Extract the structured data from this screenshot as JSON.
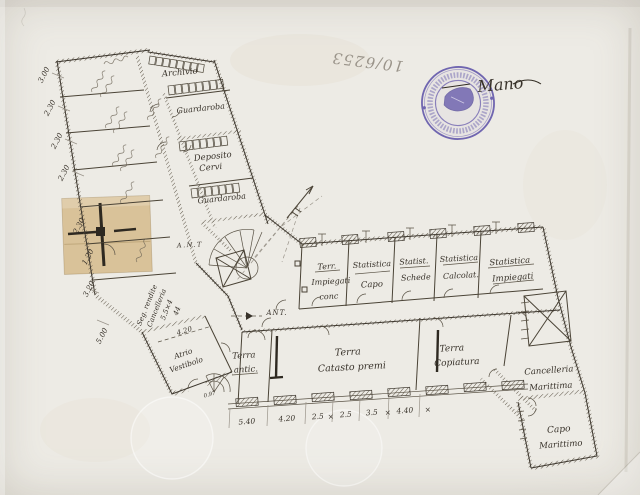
{
  "meta": {
    "inventory_number": "10/6253",
    "signature": "Mano"
  },
  "colors": {
    "paper": "#edebe5",
    "ink": "#3d372e",
    "pencil": "#9a948a",
    "stamp_purple": "#5b4fa7",
    "patch_tan": "#d8c095"
  },
  "plan": {
    "wing_rooms": {
      "archivio": "Archivio",
      "guardaroba_upper": "Guardaroba",
      "deposito_line1": "Deposito",
      "deposito_line2": "Cervi",
      "guardaroba_lower": "Guardaroba"
    },
    "main_rooms": {
      "room1_line1": "Terr.",
      "room1_line2": "Impiegati",
      "room1_line3": "conc",
      "room2_line1": "Statistica",
      "room2_line2": "Capo",
      "room3_line1": "Statist.",
      "room3_line2": "Schede",
      "room4_line1": "Statistica",
      "room4_line2": "Calcolat.",
      "room5_line1": "Statistica",
      "room5_line2": "Impiegati",
      "terra_antic_line1": "Terra",
      "terra_antic_line2": "antic.",
      "catasto_line1": "Terra",
      "catasto_line2": "Catasto premi",
      "copiatura_line1": "Terra",
      "copiatura_line2": "Copiatura",
      "cancelleria_line1": "Cancelleria",
      "cancelleria_line2": "Marittima",
      "capo_line1": "Capo",
      "capo_line2": "Marittimo",
      "vestibolo_line1": "Atrio",
      "vestibolo_line2": "Vestibolo"
    },
    "annotations": {
      "ant_upper": "A.N.T",
      "ant_lower": "ANT.",
      "seg_line1": "Seg. rendite",
      "seg_line2": "Cancelleria",
      "seg_line3": "5.5×4",
      "seg_line4": "44",
      "vestibule_dim": "4.20",
      "threshold_dim": "0.97"
    },
    "dimensions": {
      "left": [
        "3.00",
        "2.30",
        "2.30",
        "2.30"
      ],
      "patch": [
        "2.30",
        "1.20"
      ],
      "lower_left": [
        "3.20",
        "5.00"
      ],
      "bottom": [
        "5.40",
        "4.20",
        "2.5",
        "2.5",
        "3.5",
        "4.40"
      ],
      "separator": "×"
    }
  }
}
